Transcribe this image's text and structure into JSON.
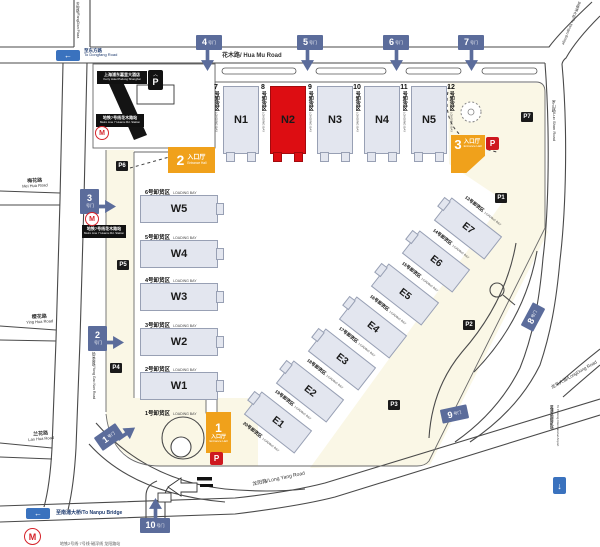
{
  "colors": {
    "hall_fill": "#E3E6EF",
    "highlight_red": "#DD0D12",
    "gate_blue": "#5B6C9B",
    "entrance_orange": "#F0A11B",
    "parking_red": "#CE181E",
    "metro_red": "#D5232A",
    "arrow_blue": "#3A72BE",
    "plaza_cream": "#FAF7E6"
  },
  "halls": {
    "north": [
      "N1",
      "N2",
      "N3",
      "N4",
      "N5"
    ],
    "west": [
      "W5",
      "W4",
      "W3",
      "W2",
      "W1"
    ],
    "east": [
      "E7",
      "E6",
      "E5",
      "E4",
      "E3",
      "E2",
      "E1"
    ],
    "highlighted": "N2"
  },
  "bays": {
    "north": [
      {
        "no": "7",
        "cn": "号卸货区",
        "en": "LOADING BAY"
      },
      {
        "no": "8",
        "cn": "号卸货区",
        "en": "LOADING BAY"
      },
      {
        "no": "9",
        "cn": "号卸货区",
        "en": "LOADING BAY"
      },
      {
        "no": "10",
        "cn": "号卸货区",
        "en": "LOADING BAY"
      },
      {
        "no": "11",
        "cn": "号卸货区",
        "en": "LOADING BAY"
      },
      {
        "no": "12",
        "cn": "号卸货区",
        "en": "LOADING BAY"
      }
    ],
    "west": [
      {
        "cn": "6号卸货区",
        "en": "LOADING BAY"
      },
      {
        "cn": "5号卸货区",
        "en": "LOADING BAY"
      },
      {
        "cn": "4号卸货区",
        "en": "LOADING BAY"
      },
      {
        "cn": "3号卸货区",
        "en": "LOADING BAY"
      },
      {
        "cn": "2号卸货区",
        "en": "LOADING BAY"
      },
      {
        "cn": "1号卸货区",
        "en": "LOADING BAY"
      }
    ],
    "east": [
      {
        "cn": "13号卸货区",
        "en": "LOADING BAY"
      },
      {
        "cn": "14号卸货区",
        "en": "LOADING BAY"
      },
      {
        "cn": "15号卸货区",
        "en": "LOADING BAY"
      },
      {
        "cn": "16号卸货区",
        "en": "LOADING BAY"
      },
      {
        "cn": "17号卸货区",
        "en": "LOADING BAY"
      },
      {
        "cn": "18号卸货区",
        "en": "LOADING BAY"
      },
      {
        "cn": "19号卸货区",
        "en": "LOADING BAY"
      },
      {
        "cn": "20号卸货区",
        "en": "LOADING BAY"
      }
    ]
  },
  "gates": [
    {
      "no": "1",
      "sfx": "号门"
    },
    {
      "no": "2",
      "sfx": "号门"
    },
    {
      "no": "3",
      "sfx": "号门"
    },
    {
      "no": "4",
      "sfx": "号门"
    },
    {
      "no": "5",
      "sfx": "号门"
    },
    {
      "no": "6",
      "sfx": "号门"
    },
    {
      "no": "7",
      "sfx": "号门"
    },
    {
      "no": "8",
      "sfx": "号门"
    },
    {
      "no": "9",
      "sfx": "号门"
    },
    {
      "no": "10",
      "sfx": "号门"
    }
  ],
  "entrances": [
    {
      "no": "1",
      "cn": "入口厅",
      "en": "Entrance Hall"
    },
    {
      "no": "2",
      "cn": "入口厅",
      "en": "Entrance Hall"
    },
    {
      "no": "3",
      "cn": "入口厅",
      "en": "Entrance Hall"
    }
  ],
  "parking": {
    "p1": "P1",
    "p2": "P2",
    "p3": "P3",
    "p4": "P4",
    "p5": "P5",
    "p6": "P6",
    "p7": "P7",
    "p": "P"
  },
  "landmarks": {
    "hotel_cn": "上海浦东嘉里大酒店",
    "hotel_en": "Kerry Hotel Pudong Shanghai",
    "metro_north_cn": "地铁7号线花木路站",
    "metro_north_en": "Metro Line 7 Huamu Rd. Station",
    "metro_west_cn": "地铁7号线花木路站",
    "metro_west_en": "Metro Line 7 Huamu Rd. Station",
    "bottom_caption": "地铁2号线·7号线·磁浮线 龙阳路站",
    "metro_m": "M"
  },
  "roads": {
    "hua_mu": "花木路/ Hua Mu Road",
    "fangdian": "芳甸路/FangDian Plaza",
    "yangpu": "至杨浦大桥/To Yangpu Bridge",
    "luoshan": "罗山路/Luo Shan Road",
    "mei_hua_cn": "梅花路",
    "mei_hua_en": "Mei Hua Road",
    "ying_hua_cn": "樱花路",
    "ying_hua_en": "Ying Hua Road",
    "lan_hua_cn": "兰花路",
    "lan_hua_en": "Lan Hua Road",
    "yang_gao": "杨高南路/Yang Gao Nan Road",
    "long_yang": "龙阳路/Long Yang Road",
    "long_dong": "龙东大道/LongDong Road",
    "dongfang_cn": "至东方路",
    "dongfang_en": "To Dongfang Road",
    "nanpu": "至南浦大桥/To Nanpu Bridge",
    "airport_cn": "至浦东国际机场",
    "airport_en": "To Pudong International Airport"
  },
  "icons": {
    "left_arrow": "←",
    "down_arrow": "↓"
  }
}
